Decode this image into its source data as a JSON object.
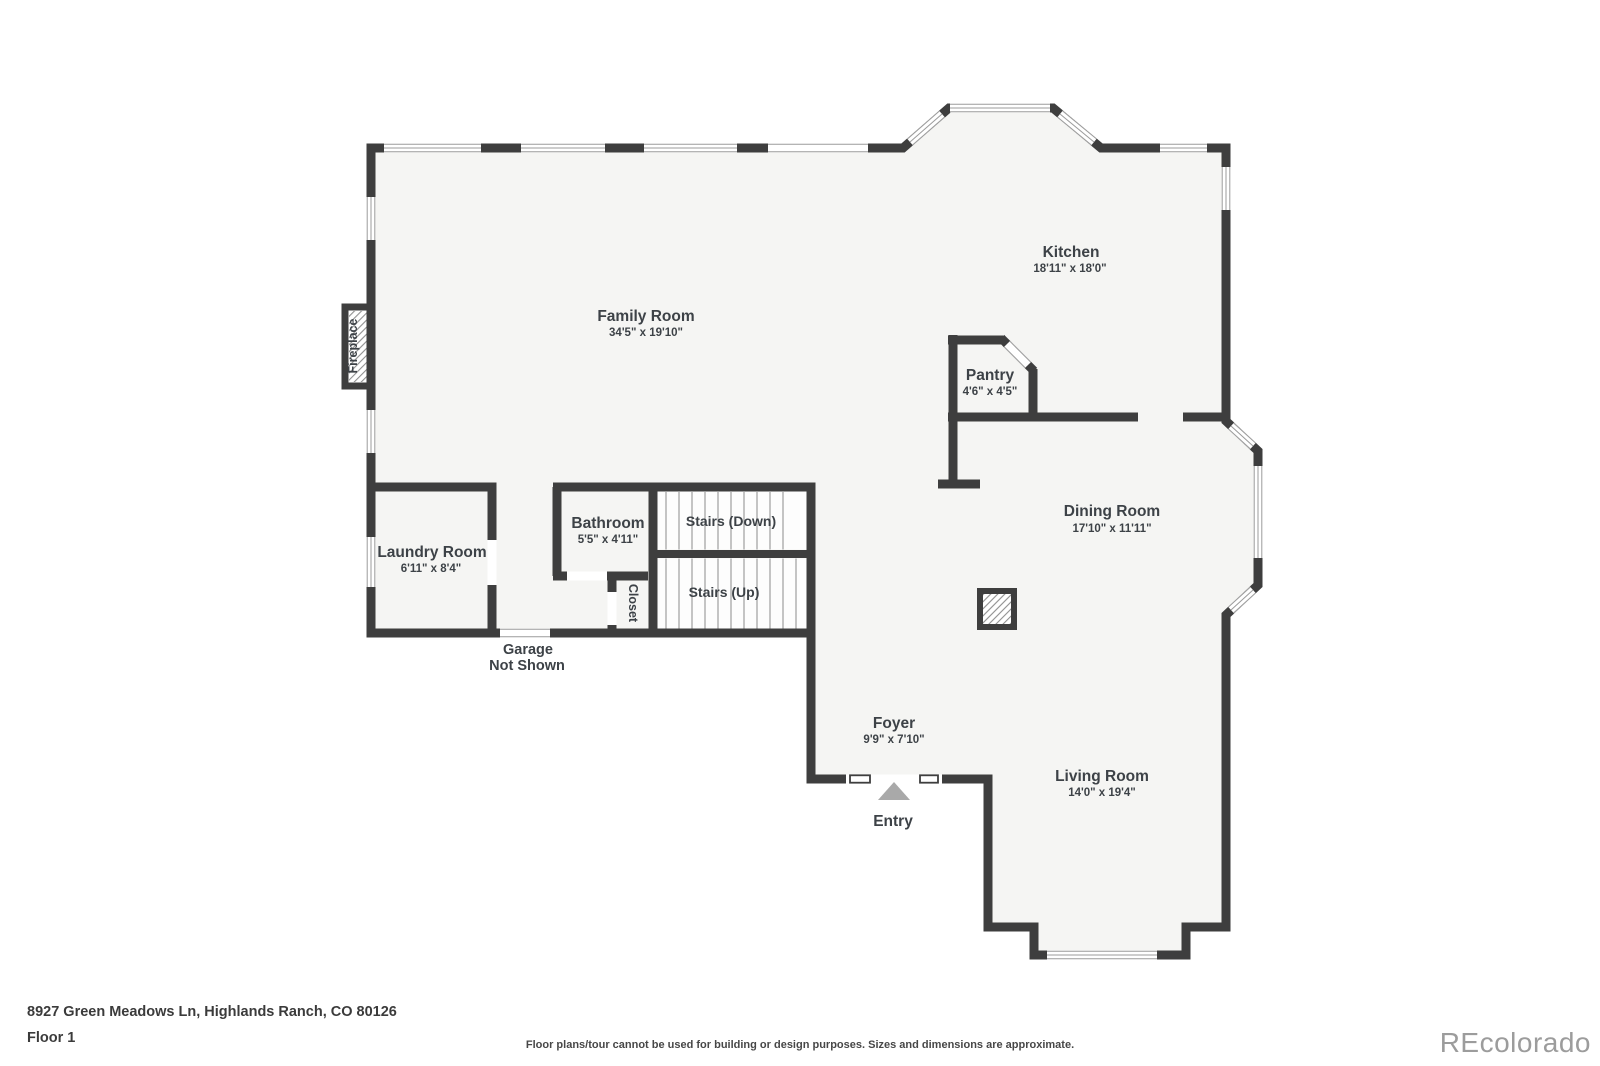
{
  "plan": {
    "wall_color": "#3e3e3e",
    "floor_color": "#f5f5f3",
    "window_line_color": "#9b9b9b",
    "entry_arrow_color": "#a9a9a9",
    "rooms": {
      "family": {
        "name": "Family Room",
        "dims": "34'5\" x 19'10\""
      },
      "kitchen": {
        "name": "Kitchen",
        "dims": "18'11\" x 18'0\""
      },
      "pantry": {
        "name": "Pantry",
        "dims": "4'6\" x 4'5\""
      },
      "dining": {
        "name": "Dining Room",
        "dims": "17'10\" x 11'11\""
      },
      "living": {
        "name": "Living Room",
        "dims": "14'0\" x 19'4\""
      },
      "foyer": {
        "name": "Foyer",
        "dims": "9'9\" x 7'10\""
      },
      "bathroom": {
        "name": "Bathroom",
        "dims": "5'5\" x 4'11\""
      },
      "laundry": {
        "name": "Laundry Room",
        "dims": "6'11\" x 8'4\""
      },
      "stairs_down": {
        "name": "Stairs (Down)"
      },
      "stairs_up": {
        "name": "Stairs (Up)"
      },
      "closet": {
        "name": "Closet"
      },
      "fireplace": {
        "name": "Fireplace"
      },
      "entry": {
        "name": "Entry"
      },
      "garage": {
        "line1": "Garage",
        "line2": "Not Shown"
      }
    }
  },
  "footer": {
    "address": "8927 Green Meadows Ln, Highlands Ranch, CO 80126",
    "floor_label": "Floor 1",
    "disclaimer": "Floor plans/tour cannot be used for building or design purposes. Sizes and dimensions are approximate.",
    "watermark": "REcolorado"
  }
}
